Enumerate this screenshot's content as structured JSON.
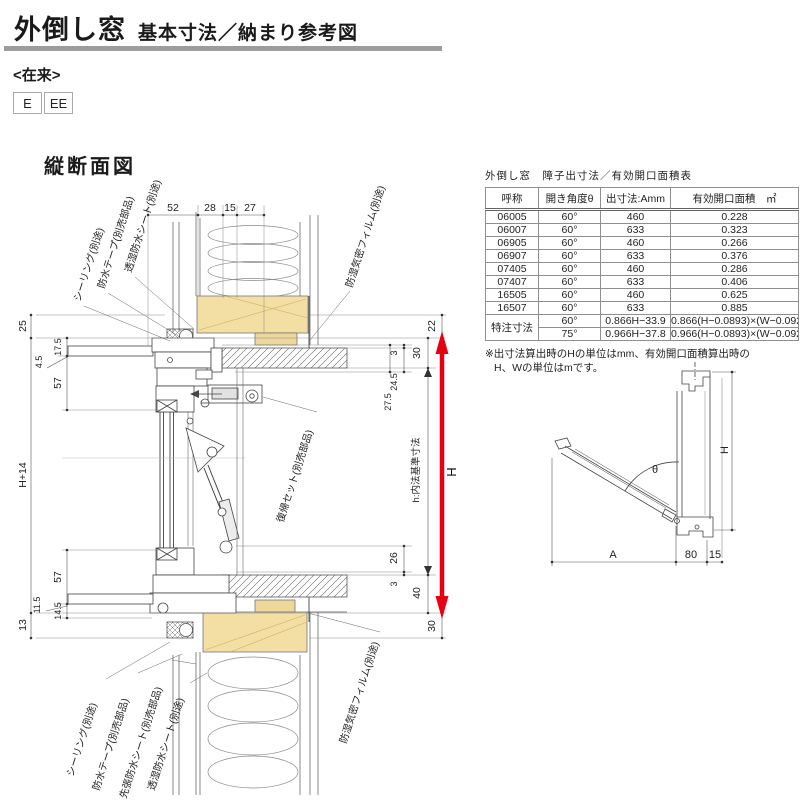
{
  "page": {
    "title_main": "外倒し窓",
    "title_sub": "基本寸法／納まり参考図",
    "construction_type": "<在来>",
    "type_codes": [
      "E",
      "EE"
    ],
    "section_view_title": "縦断面図"
  },
  "colors": {
    "accent_red": "#e60012",
    "wood_beige": "#f3dfa3",
    "rule_gray": "#9c9c9c"
  },
  "spec_table": {
    "title": "外倒し窓　障子出寸法／有効開口面積表",
    "headers": {
      "name": "呼称",
      "angle": "開き角度θ",
      "projection": "出寸法:Amm",
      "area": "有効開口面積　㎡"
    },
    "rows": [
      {
        "name": "06005",
        "angle": "60°",
        "projection": "460",
        "area": "0.228"
      },
      {
        "name": "06007",
        "angle": "60°",
        "projection": "633",
        "area": "0.323"
      },
      {
        "name": "06905",
        "angle": "60°",
        "projection": "460",
        "area": "0.266"
      },
      {
        "name": "06907",
        "angle": "60°",
        "projection": "633",
        "area": "0.376"
      },
      {
        "name": "07405",
        "angle": "60°",
        "projection": "460",
        "area": "0.286"
      },
      {
        "name": "07407",
        "angle": "60°",
        "projection": "633",
        "area": "0.406"
      },
      {
        "name": "16505",
        "angle": "60°",
        "projection": "460",
        "area": "0.625"
      },
      {
        "name": "16507",
        "angle": "60°",
        "projection": "633",
        "area": "0.885"
      }
    ],
    "custom": {
      "name": "特注寸法",
      "rows": [
        {
          "angle": "60°",
          "projection": "0.866H−33.9",
          "area": "0.866(H−0.0893)×(W−0.092)"
        },
        {
          "angle": "75°",
          "projection": "0.966H−37.8",
          "area": "0.966(H−0.0893)×(W−0.092)"
        }
      ]
    },
    "note_line1": "※出寸法算出時のHの単位はmm、有効開口面積算出時の",
    "note_line2": "H、Wの単位はmです。"
  },
  "section_drawing": {
    "top_dims": [
      "52",
      "28",
      "15",
      "27"
    ],
    "left_dims": {
      "d25": "25",
      "d17_5": "17.5",
      "d4_5": "4.5",
      "d57t": "57",
      "dh14": "H+14",
      "d57b": "57",
      "d11_5": "11.5",
      "d14_5": "14.5",
      "d13": "13"
    },
    "right_dims": {
      "d22": "22",
      "d30t": "30",
      "d3t": "3",
      "d24_5": "24.5",
      "d27_5": "27.5",
      "d26": "26",
      "d3b": "3",
      "d40": "40",
      "d30b": "30",
      "dH": "H",
      "dh_inner": "h:内法基準寸法"
    },
    "part_labels_top": [
      "シーリング(別途)",
      "防水テープ(別売部品)",
      "透湿防水シート(別途)",
      "防湿気密フィルム(別途)"
    ],
    "part_label_mid": "復帰セット(別売部品)",
    "part_labels_bottom": [
      "シーリング(別途)",
      "防水テープ(別売部品)",
      "先張防水シート(別売部品)",
      "透湿防水シート(別途)",
      "防湿気密フィルム(別途)"
    ]
  },
  "angle_diagram": {
    "theta": "θ",
    "height": "H",
    "depth": "A",
    "d80": "80",
    "d15": "15"
  }
}
